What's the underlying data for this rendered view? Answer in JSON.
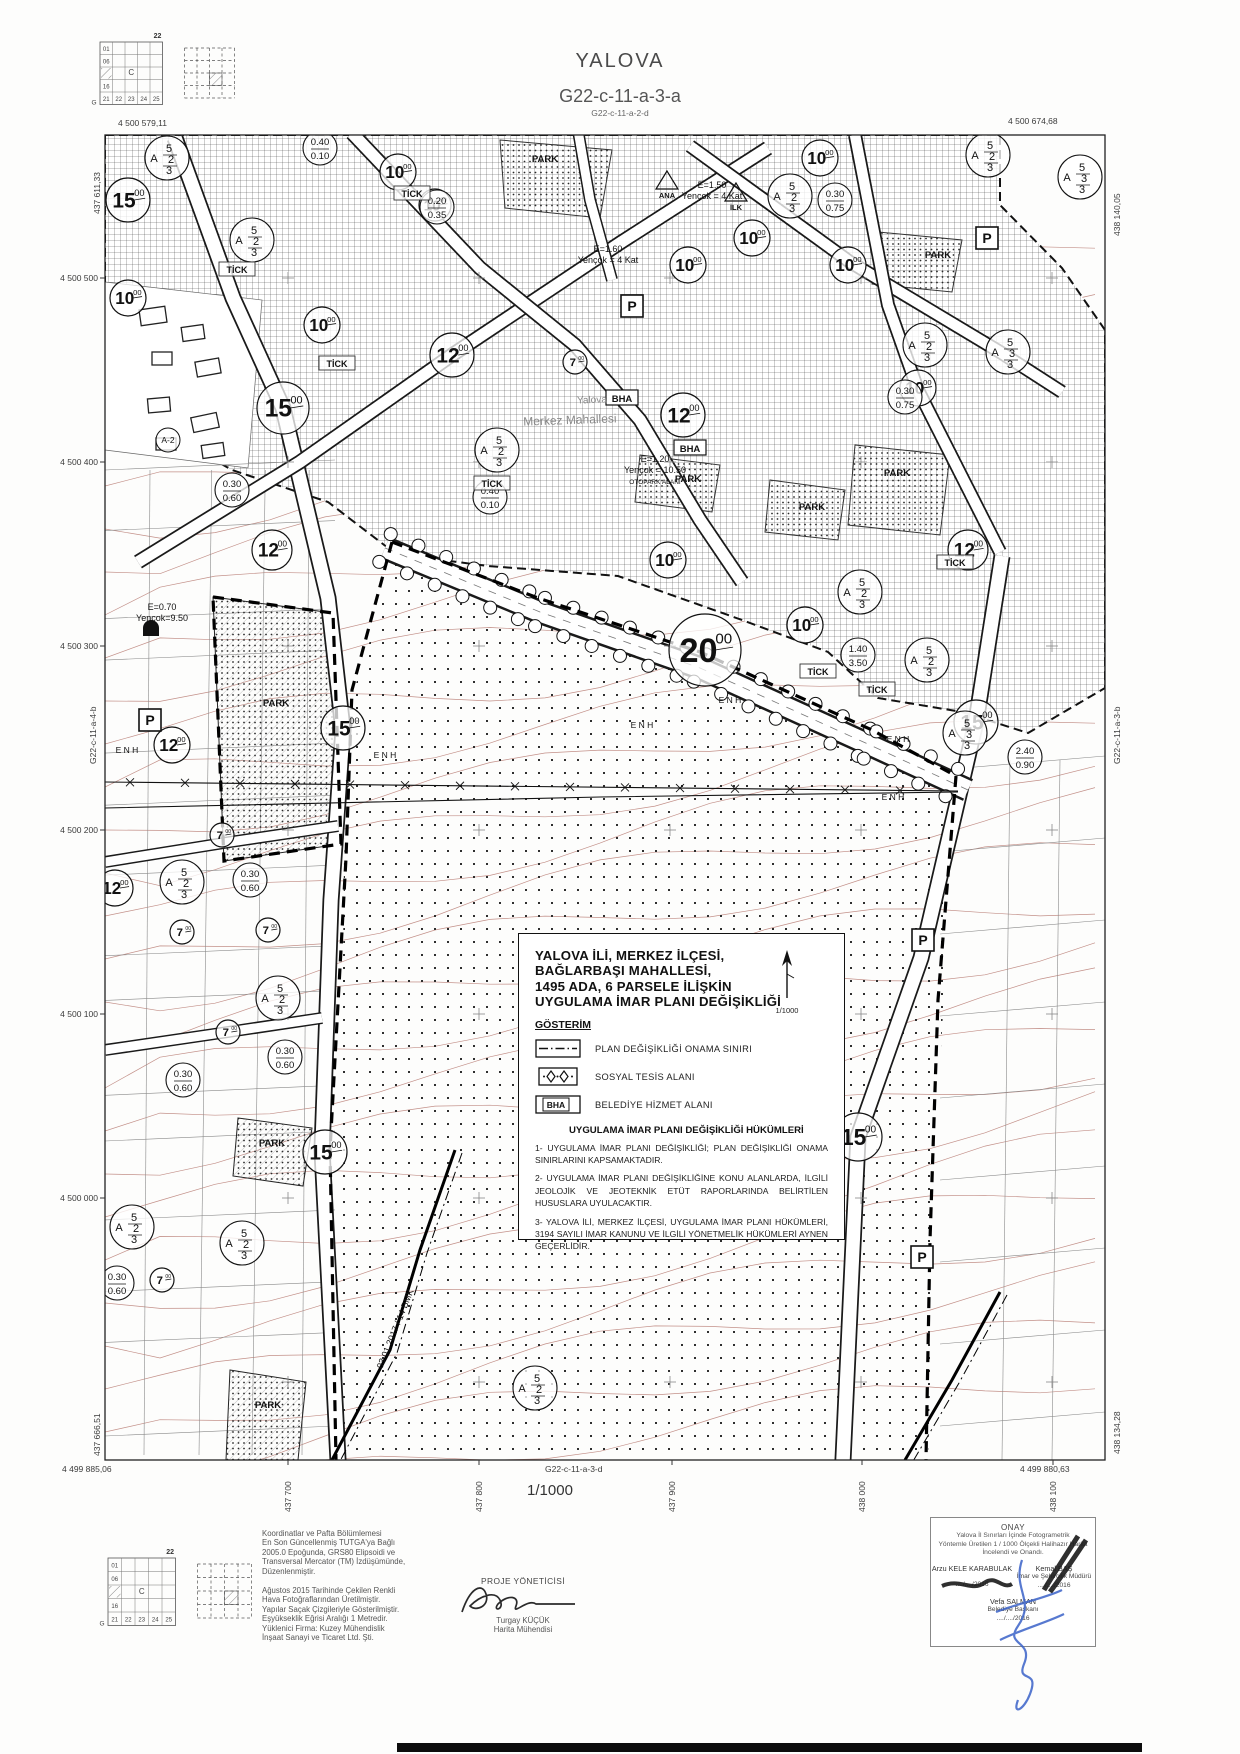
{
  "page": {
    "title": "YALOVA",
    "sheet": "G22-c-11-a-3-a",
    "neighbor_top": "G22-c-11-a-2-d",
    "neighbor_bottom": "G22-c-11-a-3-d",
    "neighbor_left": "G22-c-11-a-4-b",
    "neighbor_right": "G22-c-11-a-3-b",
    "scale_label": "1/1000"
  },
  "frame": {
    "corner_tl": "4 500 579,11",
    "corner_tr": "4 500 674,68",
    "corner_bl": "4 499 885,06",
    "corner_br": "4 499 880,63",
    "edge_left_top": "437 611,33",
    "edge_left_bottom": "437 666,51",
    "edge_right_top": "438 140,05",
    "edge_right_bottom": "438 134,28",
    "left_ticks": [
      "4 500 500",
      "4 500 400",
      "4 500 300",
      "4 500 200",
      "4 500 100",
      "4 500 000"
    ],
    "bottom_ticks": [
      "437 700",
      "437 800",
      "437 900",
      "438 000",
      "438 100"
    ]
  },
  "index_grid": {
    "top_label": "22",
    "corner_label": "G",
    "center": "C",
    "left_labels": [
      "01",
      "06",
      "16"
    ],
    "bottom_labels": [
      "21",
      "22",
      "23",
      "24",
      "25"
    ]
  },
  "title_block": {
    "line1": "YALOVA İLİ, MERKEZ İLÇESİ,",
    "line2": "BAĞLARBAŞI MAHALLESİ,",
    "line3": "1495 ADA, 6 PARSELE İLİŞKİN",
    "line4": "UYGULAMA İMAR PLANI DEĞİŞİKLİĞİ",
    "north_scale": "1/1000",
    "legend_title": "GÖSTERİM",
    "legend": [
      {
        "label": "PLAN DEĞİŞİKLİĞİ ONAMA SINIRI"
      },
      {
        "label": "SOSYAL TESİS ALANI"
      },
      {
        "label": "BELEDİYE HİZMET ALANI"
      }
    ],
    "bha_abbrev": "BHA",
    "provisions_title": "UYGULAMA İMAR PLANI DEĞİŞİKLİĞİ HÜKÜMLERİ",
    "provisions": [
      "1- UYGULAMA İMAR PLANI DEĞİŞİKLİĞİ; PLAN DEĞİŞİKLİĞİ ONAMA SINIRLARINI KAPSAMAKTADIR.",
      "2- UYGULAMA İMAR PLANI DEĞİŞİKLİĞİNE KONU ALANLARDA, İLGİLİ JEOLOJİK VE JEOTEKNİK ETÜT RAPORLARINDA BELİRTİLEN HUSUSLARA UYULACAKTIR.",
      "3- YALOVA İLİ, MERKEZ İLÇESİ, UYGULAMA İMAR PLANI HÜKÜMLERİ, 3194 SAYILI İMAR KANUNU VE İLGİLİ YÖNETMELİK HÜKÜMLERİ AYNEN GEÇERLİDİR."
    ]
  },
  "footer": {
    "coord_note": [
      "Koordinatlar ve Pafta Bölümlemesi",
      "En Son Güncellenmiş TUTGA'ya Bağlı",
      "2005.0 Epoğunda, GRS80 Elipsoidi ve",
      "Transversal Mercator (TM) İzdüşümünde,",
      "Düzenlenmiştir."
    ],
    "production_note": [
      "Ağustos 2015 Tarihinde Çekilen Renkli",
      "Hava Fotoğraflarından Üretilmiştir.",
      "Yapılar Saçak Çizgileriyle Gösterilmiştir.",
      "Eşyükseklik Eğrisi Aralığı 1 Metredir.",
      "Yüklenici Firma: Kuzey Mühendislik",
      "İnşaat Sanayi ve Ticaret Ltd. Şti."
    ],
    "pm_title": "PROJE YÖNETİCİSİ",
    "pm_name": "Turgay KÜÇÜK",
    "pm_role": "Harita Mühendisi",
    "approval": {
      "title": "ONAY",
      "line1": "Yalova İl Sınırları İçinde  Fotogrametrik",
      "line2": "Yöntemle Üretilen 1 / 1000  Ölçekli Halihazır Harita",
      "line3": "İncelendi ve Onandı.",
      "signer1_name": "Arzu KELE KARABULAK",
      "signer2_name": "Kemal BAŞ",
      "signer2_role": "İmar ve Şehircilik Müdürü",
      "date": "..../..../2016",
      "mayor_name": "Vefa SALMAN",
      "mayor_role": "Belediye Başkanı"
    }
  },
  "map": {
    "road_width_circles": [
      {
        "x": 283,
        "y": 408,
        "v": "15.00",
        "r": 26
      },
      {
        "x": 343,
        "y": 728,
        "v": "15.00",
        "r": 22
      },
      {
        "x": 976,
        "y": 722,
        "v": "15.00",
        "r": 22
      },
      {
        "x": 858,
        "y": 1137,
        "v": "15.00",
        "r": 24
      },
      {
        "x": 325,
        "y": 1152,
        "v": "15.00",
        "r": 22
      },
      {
        "x": 128,
        "y": 200,
        "v": "15.00",
        "r": 22
      },
      {
        "x": 705,
        "y": 650,
        "v": "20.00",
        "r": 36
      },
      {
        "x": 452,
        "y": 355,
        "v": "12.00",
        "r": 22
      },
      {
        "x": 272,
        "y": 550,
        "v": "12.00",
        "r": 20
      },
      {
        "x": 683,
        "y": 415,
        "v": "12.00",
        "r": 22
      },
      {
        "x": 968,
        "y": 550,
        "v": "12.00",
        "r": 20
      },
      {
        "x": 172,
        "y": 745,
        "v": "12.00",
        "r": 18
      },
      {
        "x": 115,
        "y": 888,
        "v": "12.00",
        "r": 18
      },
      {
        "x": 398,
        "y": 172,
        "v": "10.00",
        "r": 18
      },
      {
        "x": 435,
        "y": 205,
        "v": "10.00",
        "r": 16
      },
      {
        "x": 322,
        "y": 325,
        "v": "10.00",
        "r": 18
      },
      {
        "x": 688,
        "y": 265,
        "v": "10.00",
        "r": 18
      },
      {
        "x": 752,
        "y": 238,
        "v": "10.00",
        "r": 18
      },
      {
        "x": 848,
        "y": 265,
        "v": "10.00",
        "r": 18
      },
      {
        "x": 820,
        "y": 158,
        "v": "10.00",
        "r": 18
      },
      {
        "x": 918,
        "y": 388,
        "v": "10.00",
        "r": 18
      },
      {
        "x": 668,
        "y": 560,
        "v": "10.00",
        "r": 18
      },
      {
        "x": 805,
        "y": 625,
        "v": "10.00",
        "r": 18
      },
      {
        "x": 128,
        "y": 298,
        "v": "10.00",
        "r": 18
      },
      {
        "x": 575,
        "y": 362,
        "v": "7.00",
        "r": 12
      },
      {
        "x": 222,
        "y": 835,
        "v": "7.00",
        "r": 12
      },
      {
        "x": 182,
        "y": 932,
        "v": "7.00",
        "r": 12
      },
      {
        "x": 268,
        "y": 930,
        "v": "7.00",
        "r": 12
      },
      {
        "x": 228,
        "y": 1032,
        "v": "7.00",
        "r": 12
      },
      {
        "x": 162,
        "y": 1280,
        "v": "7.00",
        "r": 12
      }
    ],
    "zone_circles": [
      {
        "x": 167,
        "y": 158,
        "a": "A",
        "rows": [
          "5",
          "2",
          "3"
        ]
      },
      {
        "x": 252,
        "y": 240,
        "a": "A",
        "rows": [
          "5",
          "2",
          "3"
        ]
      },
      {
        "x": 790,
        "y": 196,
        "a": "A",
        "rows": [
          "5",
          "2",
          "3"
        ]
      },
      {
        "x": 988,
        "y": 155,
        "a": "A",
        "rows": [
          "5",
          "2",
          "3"
        ]
      },
      {
        "x": 497,
        "y": 450,
        "a": "A",
        "rows": [
          "5",
          "2",
          "3"
        ]
      },
      {
        "x": 860,
        "y": 592,
        "a": "A",
        "rows": [
          "5",
          "2",
          "3"
        ]
      },
      {
        "x": 927,
        "y": 660,
        "a": "A",
        "rows": [
          "5",
          "2",
          "3"
        ]
      },
      {
        "x": 182,
        "y": 882,
        "a": "A",
        "rows": [
          "5",
          "2",
          "3"
        ]
      },
      {
        "x": 278,
        "y": 998,
        "a": "A",
        "rows": [
          "5",
          "2",
          "3"
        ]
      },
      {
        "x": 132,
        "y": 1227,
        "a": "A",
        "rows": [
          "5",
          "2",
          "3"
        ]
      },
      {
        "x": 242,
        "y": 1243,
        "a": "A",
        "rows": [
          "5",
          "2",
          "3"
        ]
      },
      {
        "x": 925,
        "y": 345,
        "a": "A",
        "rows": [
          "5",
          "2",
          "3"
        ]
      },
      {
        "x": 1080,
        "y": 177,
        "a": "A",
        "rows": [
          "5",
          "3",
          "3"
        ]
      },
      {
        "x": 965,
        "y": 733,
        "a": "A",
        "rows": [
          "5",
          "3",
          "3"
        ]
      },
      {
        "x": 1008,
        "y": 352,
        "a": "A",
        "rows": [
          "5",
          "3",
          "3"
        ]
      },
      {
        "x": 535,
        "y": 1388,
        "a": "A",
        "rows": [
          "5",
          "2",
          "3"
        ]
      }
    ],
    "ratio_circles": [
      {
        "x": 232,
        "y": 490,
        "top": "0.30",
        "bot": "0.60"
      },
      {
        "x": 250,
        "y": 880,
        "top": "0.30",
        "bot": "0.60"
      },
      {
        "x": 285,
        "y": 1057,
        "top": "0.30",
        "bot": "0.60"
      },
      {
        "x": 183,
        "y": 1080,
        "top": "0.30",
        "bot": "0.60"
      },
      {
        "x": 117,
        "y": 1283,
        "top": "0.30",
        "bot": "0.60"
      },
      {
        "x": 320,
        "y": 148,
        "top": "0.40",
        "bot": "0.10"
      },
      {
        "x": 437,
        "y": 207,
        "top": "0.20",
        "bot": "0.35"
      },
      {
        "x": 835,
        "y": 200,
        "top": "0.30",
        "bot": "0.75"
      },
      {
        "x": 905,
        "y": 397,
        "top": "0.30",
        "bot": "0.75"
      },
      {
        "x": 490,
        "y": 497,
        "top": "0.40",
        "bot": "0.10"
      },
      {
        "x": 858,
        "y": 655,
        "top": "1.40",
        "bot": "3.50"
      },
      {
        "x": 1025,
        "y": 757,
        "top": "2.40",
        "bot": "0.90"
      }
    ],
    "small_circles": [
      {
        "x": 168,
        "y": 440,
        "text": "A-2"
      }
    ],
    "park_text": "PARK",
    "park_labels": [
      [
        545,
        162
      ],
      [
        938,
        258
      ],
      [
        897,
        476
      ],
      [
        812,
        510
      ],
      [
        276,
        706
      ],
      [
        272,
        1146
      ],
      [
        688,
        482
      ],
      [
        268,
        1408
      ]
    ],
    "tick_text": "TİCK",
    "tick_labels": [
      [
        237,
        272
      ],
      [
        412,
        196
      ],
      [
        337,
        366
      ],
      [
        492,
        486
      ],
      [
        818,
        674
      ],
      [
        955,
        565
      ],
      [
        877,
        692
      ]
    ],
    "bha_text": "BHA",
    "bha_labels": [
      [
        622,
        400
      ],
      [
        690,
        450
      ]
    ],
    "parking_text": "P",
    "parking_labels": [
      [
        632,
        306
      ],
      [
        987,
        238
      ],
      [
        923,
        940
      ],
      [
        922,
        1257
      ],
      [
        150,
        720
      ]
    ],
    "school_symbols": [
      {
        "x": 667,
        "y": 185,
        "label": "ANA"
      },
      {
        "x": 736,
        "y": 197,
        "label": "İLK"
      }
    ],
    "enh_text": "E N H",
    "enh_positions": [
      [
        127,
        753
      ],
      [
        385,
        758
      ],
      [
        642,
        728
      ],
      [
        730,
        703
      ],
      [
        898,
        742
      ],
      [
        893,
        800
      ]
    ],
    "emsal_notes": [
      {
        "x": 608,
        "y": 252,
        "lines": [
          "E=1.60",
          "Yençok = 4 Kat"
        ]
      },
      {
        "x": 712,
        "y": 188,
        "lines": [
          "E=1.50",
          "Yençok = 4 Kat"
        ]
      },
      {
        "x": 655,
        "y": 462,
        "lines": [
          "E=1.20",
          "Yençok = 10.50",
          "OTOPARK ALANI"
        ]
      },
      {
        "x": 162,
        "y": 610,
        "lines": [
          "E=0.70",
          "Yençok=9.50"
        ]
      }
    ],
    "place_labels": [
      {
        "x": 592,
        "y": 403,
        "text": "Yalova",
        "size": 10
      },
      {
        "x": 570,
        "y": 424,
        "text": "Merkez Mahallesi",
        "size": 12
      }
    ],
    "pipeline_label": {
      "x": 398,
      "y": 1330,
      "text": "03.01.2017 / 14 BMK",
      "rot": -68
    }
  }
}
